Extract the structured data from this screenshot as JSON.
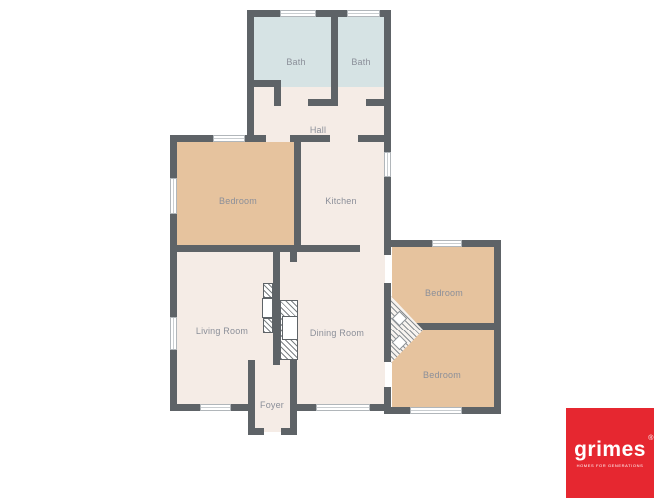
{
  "rooms": [
    {
      "id": "bath-1",
      "label": "Bath"
    },
    {
      "id": "bath-2",
      "label": "Bath"
    },
    {
      "id": "hall",
      "label": "Hall"
    },
    {
      "id": "bedroom-1",
      "label": "Bedroom"
    },
    {
      "id": "kitchen",
      "label": "Kitchen"
    },
    {
      "id": "living-room",
      "label": "Living Room"
    },
    {
      "id": "dining-room",
      "label": "Dining Room"
    },
    {
      "id": "bedroom-2",
      "label": "Bedroom"
    },
    {
      "id": "bedroom-3",
      "label": "Bedroom"
    },
    {
      "id": "foyer",
      "label": "Foyer"
    }
  ],
  "colors": {
    "wall": "#5e6367",
    "bathroom_fill": "#d6e3e4",
    "bedroom_fill": "#e6c39e",
    "common_fill": "#f5ece6",
    "label_text": "#8b8f99",
    "logo_background": "#e62730",
    "logo_text": "#ffffff"
  },
  "logo": {
    "brand": "grimes",
    "registered_mark": "®",
    "tagline": "HOMES FOR GENERATIONS"
  }
}
